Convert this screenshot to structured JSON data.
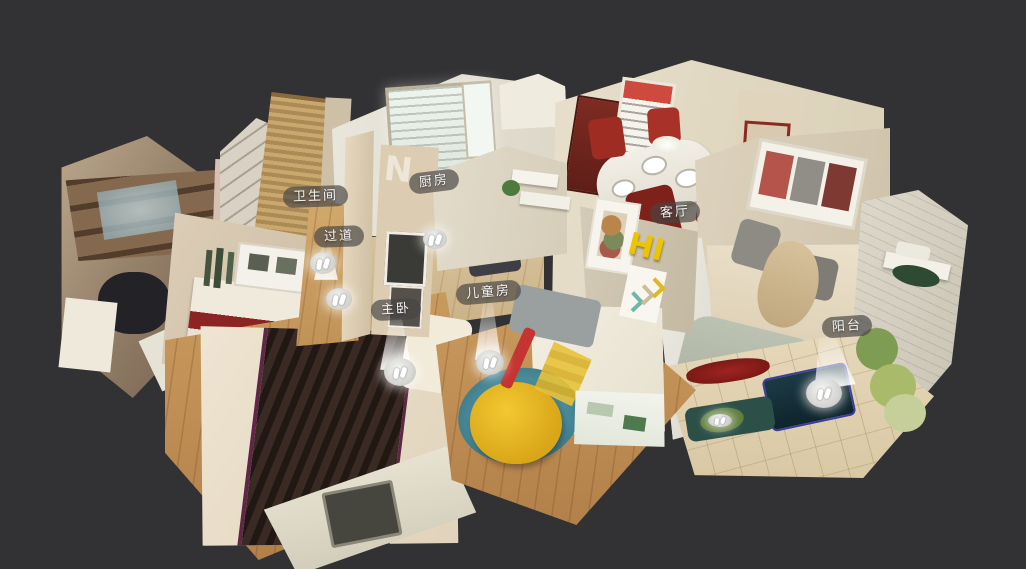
{
  "scene": {
    "background_color": "#323234",
    "description_kind": "3d-dollhouse-apartment-view"
  },
  "room_labels": [
    {
      "id": "bathroom",
      "text": "卫生间"
    },
    {
      "id": "hallway",
      "text": "过道"
    },
    {
      "id": "kitchen",
      "text": "厨房"
    },
    {
      "id": "master-bedroom",
      "text": "主卧"
    },
    {
      "id": "kids-room",
      "text": "儿童房"
    },
    {
      "id": "living-room",
      "text": "客厅"
    },
    {
      "id": "balcony",
      "text": "阳台"
    }
  ],
  "wall_decor": {
    "hi_text": "HI",
    "wall_letter": "N"
  },
  "markers": {
    "icon": "footprints-icon",
    "ids": [
      "hallway-upper",
      "hallway-lower",
      "kitchen",
      "master-bedroom",
      "kids-room",
      "balcony",
      "balcony-bench"
    ]
  },
  "colors": {
    "label_pill": "rgba(72,70,68,0.68)",
    "label_text": "#f3f3f3",
    "marker_glow": "#ffffff",
    "bed_runner": "#33241f",
    "bean_bag": "#e8b820",
    "kids_rug": "#3f7d8c",
    "dining_chair_red": "#9e2c23",
    "entry_door_red": "#7e2b22",
    "balcony_table_teal": "#1c3a44",
    "wood_floor": "#c4945a"
  }
}
